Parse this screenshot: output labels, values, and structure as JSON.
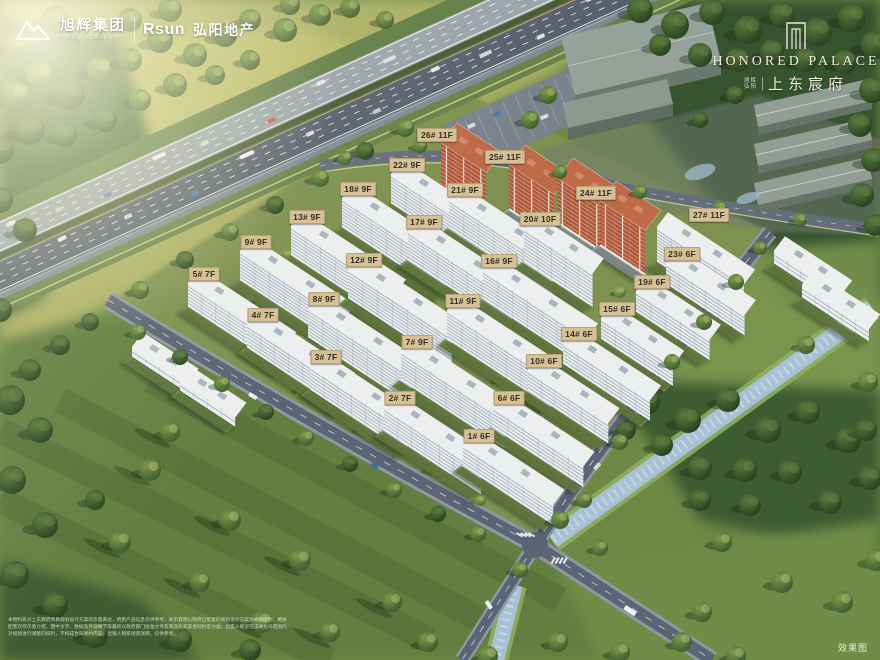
{
  "header": {
    "cifi": {
      "name_cn": "旭辉集团",
      "name_en": "CIFI GROUP"
    },
    "rsun": {
      "name_en": "Rsun",
      "name_cn": "弘阳地产"
    }
  },
  "brand": {
    "title_en": "HONORED PALACE",
    "dev": [
      "旭辉",
      "弘阳"
    ],
    "title_cn": "上东宸府"
  },
  "buildings": [
    {
      "label": "1# 6F",
      "x": 479,
      "y": 436
    },
    {
      "label": "2# 7F",
      "x": 400,
      "y": 398
    },
    {
      "label": "3# 7F",
      "x": 326,
      "y": 357
    },
    {
      "label": "4# 7F",
      "x": 263,
      "y": 315
    },
    {
      "label": "5# 7F",
      "x": 204,
      "y": 274
    },
    {
      "label": "6# 6F",
      "x": 509,
      "y": 398
    },
    {
      "label": "7# 9F",
      "x": 417,
      "y": 342
    },
    {
      "label": "8# 9F",
      "x": 324,
      "y": 299
    },
    {
      "label": "9# 9F",
      "x": 256,
      "y": 242
    },
    {
      "label": "10# 6F",
      "x": 544,
      "y": 361
    },
    {
      "label": "11# 9F",
      "x": 463,
      "y": 301
    },
    {
      "label": "12# 9F",
      "x": 364,
      "y": 260
    },
    {
      "label": "13# 9F",
      "x": 307,
      "y": 217
    },
    {
      "label": "14# 6F",
      "x": 579,
      "y": 334
    },
    {
      "label": "15# 6F",
      "x": 617,
      "y": 309
    },
    {
      "label": "16# 9F",
      "x": 499,
      "y": 261
    },
    {
      "label": "17# 9F",
      "x": 424,
      "y": 222
    },
    {
      "label": "18# 9F",
      "x": 358,
      "y": 189
    },
    {
      "label": "19# 6F",
      "x": 652,
      "y": 282
    },
    {
      "label": "20# 10F",
      "x": 540,
      "y": 219
    },
    {
      "label": "21# 9F",
      "x": 465,
      "y": 190
    },
    {
      "label": "22# 9F",
      "x": 407,
      "y": 165
    },
    {
      "label": "23# 6F",
      "x": 682,
      "y": 254
    },
    {
      "label": "24# 11F",
      "x": 596,
      "y": 193
    },
    {
      "label": "25# 11F",
      "x": 505,
      "y": 157
    },
    {
      "label": "26# 11F",
      "x": 437,
      "y": 135
    },
    {
      "label": "27# 11F",
      "x": 709,
      "y": 215
    }
  ],
  "footer": {
    "disclaimer_lines": [
      "本物料系对上东宸府项目规划设计方案的示意表达，销售产品信息仅供参考；本示意图以政府已批复的规划设计方案为依据绘制，相关",
      "配套仅作示意介绍，图中文字、数据及外观细节等最终以政府部门批准文件及商品房买卖合同约定为准；出卖人保留在法律允许范围内",
      "对规划进行调整的权利，不构成合同要约内容；出镜人物系场景演绎，仅供参考。"
    ],
    "watermark": "效果图"
  },
  "colors": {
    "label_bg": "#d6c196",
    "label_border": "#b6a178",
    "label_text": "#322e27",
    "water": "#a6c2d4",
    "road": "#5a6474",
    "grass": "#6d8845",
    "brick": "#b2583a"
  }
}
